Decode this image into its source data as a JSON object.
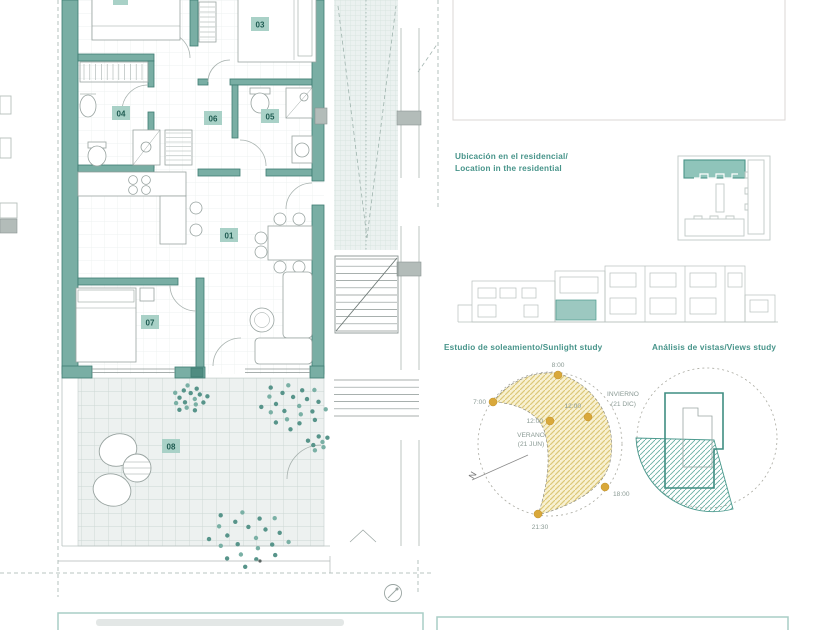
{
  "floor_plan": {
    "room_labels": [
      {
        "label": "01"
      },
      {
        "label": "03"
      },
      {
        "label": "04"
      },
      {
        "label": "05"
      },
      {
        "label": "06"
      },
      {
        "label": "07"
      },
      {
        "label": "08"
      }
    ]
  },
  "location_section": {
    "title_es": "Ubicación en el residencial/",
    "title_en": "Location in the residential"
  },
  "sunlight_study": {
    "title": "Estudio de soleamiento/Sunlight study",
    "north_label": "N",
    "labels": {
      "t8": "8:00",
      "t7": "7:00",
      "t12_summer": "12:00",
      "t12_winter": "12:00",
      "t18": "18:00",
      "t2130": "21:30",
      "summer_name": "VERANO",
      "summer_date": "(21 JUN)",
      "winter_name": "INVIERNO",
      "winter_date": "(21 DIC)"
    }
  },
  "views_study": {
    "title": "Análisis de vistas/Views study"
  },
  "colors": {
    "accent": "#47948a",
    "wall_teal": "#79aea4",
    "label_bg": "#a9d1c7",
    "label_text": "#1e5b51",
    "sun_dot": "#d9a83a",
    "sun_fill": "#f8f1d2"
  }
}
